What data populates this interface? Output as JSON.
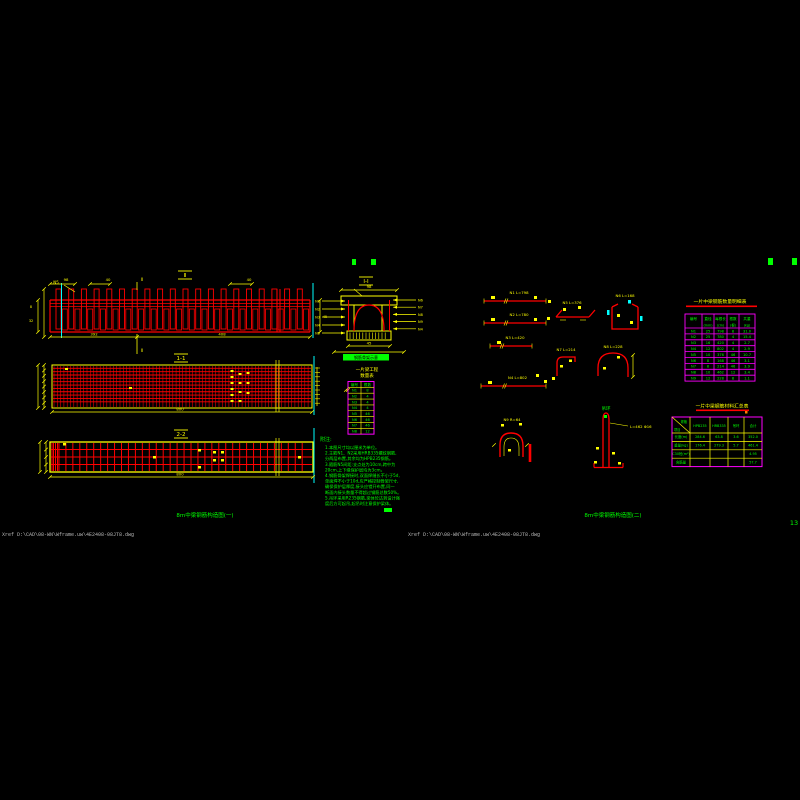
{
  "colors": {
    "bg": "#000000",
    "red": "#ff0000",
    "yellow": "#ffff00",
    "green": "#00ff00",
    "magenta": "#ff00ff",
    "cyan": "#00ffff",
    "gray": "#b9b9b9",
    "orange": "#ff7f00",
    "black": "#000000"
  },
  "elevation": {
    "mark": "Ⅱ",
    "leader": "N5",
    "side_dim": "45",
    "stirrups": 20,
    "dims_top": [
      {
        "x": 57,
        "t": "98"
      },
      {
        "x": 99,
        "t": "40"
      },
      {
        "x": 240,
        "t": "40"
      }
    ],
    "dims_bottom": [
      {
        "x": 94,
        "t": "392"
      },
      {
        "x": 222,
        "t": "408"
      }
    ]
  },
  "plan1": {
    "label": "1-1",
    "dim": "800",
    "cols": 78,
    "rows": 11
  },
  "plan2": {
    "label": "2-2",
    "dim": "800",
    "cols": 37,
    "rows": 3
  },
  "section": {
    "label": "Ⅰ-Ⅰ",
    "dim_top": "98",
    "dim_bottom": "45",
    "left": [
      "N1",
      "N2",
      "N3",
      "N4",
      "N5"
    ],
    "right": [
      "N6",
      "N7",
      "N8",
      "N9",
      "N4"
    ]
  },
  "green_tag": "钢筋骨架示意",
  "mini_table": {
    "title1": "一片梁工程",
    "title2": "数量表",
    "rows": [
      [
        "编号",
        "根数"
      ],
      [
        "N1",
        "8"
      ],
      [
        "N2",
        "4"
      ],
      [
        "N3",
        "4"
      ],
      [
        "N4",
        "4"
      ],
      [
        "N5",
        "46"
      ],
      [
        "N6",
        "46"
      ],
      [
        "N7",
        "46"
      ],
      [
        "N8",
        "12"
      ]
    ]
  },
  "notes": {
    "title": "附注:",
    "lines": [
      "1.本图尺寸均以厘米为单位。",
      "2.主筋N1、N2采用HRB335螺纹钢筋,",
      "  分两层布置,其余均为HPB235钢筋。",
      "3.箍筋N5间距:支点处为10cm,跨中为",
      "  20cm,上下缘保护层均为3cm。",
      "4.钢筋骨架焊接时,双面焊缝长不小于5d,",
      "  单面焊不小于10d,应严格控制骨架尺寸,",
      "  确保保护层厚度,接头应错开布置,同一",
      "  断面内接头数量不得超过钢筋总数50%。",
      "5.吊环采用R235钢筋,梁体砼达到设计强",
      "  度后方可起吊,起吊时注意保护梁体。"
    ]
  },
  "shapes": {
    "labels": [
      "N1  L=798",
      "N2  L=780",
      "N3  L=420",
      "N4  L=802",
      "N5  L=376",
      "N6  L=168",
      "N7  L=214",
      "N8  L=228",
      "N9  R=64"
    ]
  },
  "lift": {
    "green": "吊环",
    "dim": "L=462 Φ16"
  },
  "table1": {
    "title": "一片中梁钢筋数量明细表",
    "headers": [
      "编号",
      "直径",
      "每根长",
      "根数",
      "共重"
    ],
    "sub": [
      "",
      "(mm)",
      "(cm)",
      "(根)",
      "(kg)"
    ],
    "rows": [
      [
        "N1",
        "25",
        "798",
        "8",
        "31.0"
      ],
      [
        "N2",
        "25",
        "780",
        "4",
        "15.4"
      ],
      [
        "N3",
        "16",
        "420",
        "4",
        "2.7"
      ],
      [
        "N4",
        "12",
        "802",
        "4",
        "2.9"
      ],
      [
        "N5",
        "10",
        "376",
        "46",
        "10.7"
      ],
      [
        "N6",
        "8",
        "168",
        "46",
        "3.1"
      ],
      [
        "N7",
        "8",
        "214",
        "46",
        "3.9"
      ],
      [
        "N8",
        "10",
        "462",
        "12",
        "3.4"
      ],
      [
        "N9",
        "12",
        "228",
        "8",
        "1.1"
      ]
    ]
  },
  "table2": {
    "title": "一片中梁钢筋材料汇总表",
    "corner_top": "规格",
    "corner_bottom": "项目",
    "headers": [
      "HPB235",
      "HRB335",
      "吊环",
      "合计"
    ],
    "rows": [
      [
        "长度(m)",
        "284.6",
        "63.8",
        "3.6",
        "352.0"
      ],
      [
        "重量(kg)",
        "176.4",
        "279.3",
        "5.7",
        "461.4"
      ],
      [
        "C30砼(m³)",
        "",
        "",
        "",
        "4.95"
      ],
      [
        "含筋量",
        "",
        "",
        "",
        "57.7"
      ]
    ]
  },
  "footer": {
    "title_left": "8m中梁钢筋构造图(一)",
    "title_right": "8m中梁钢筋构造图(二)",
    "xref_left": "Xref  D:\\CAD\\08-WN\\Wframe.uw\\4E2408-08JT8.dwg",
    "xref_right": "Xref  D:\\CAD\\08-WN\\Wframe.uw\\4E2408-08JT8.dwg",
    "page": "13"
  }
}
